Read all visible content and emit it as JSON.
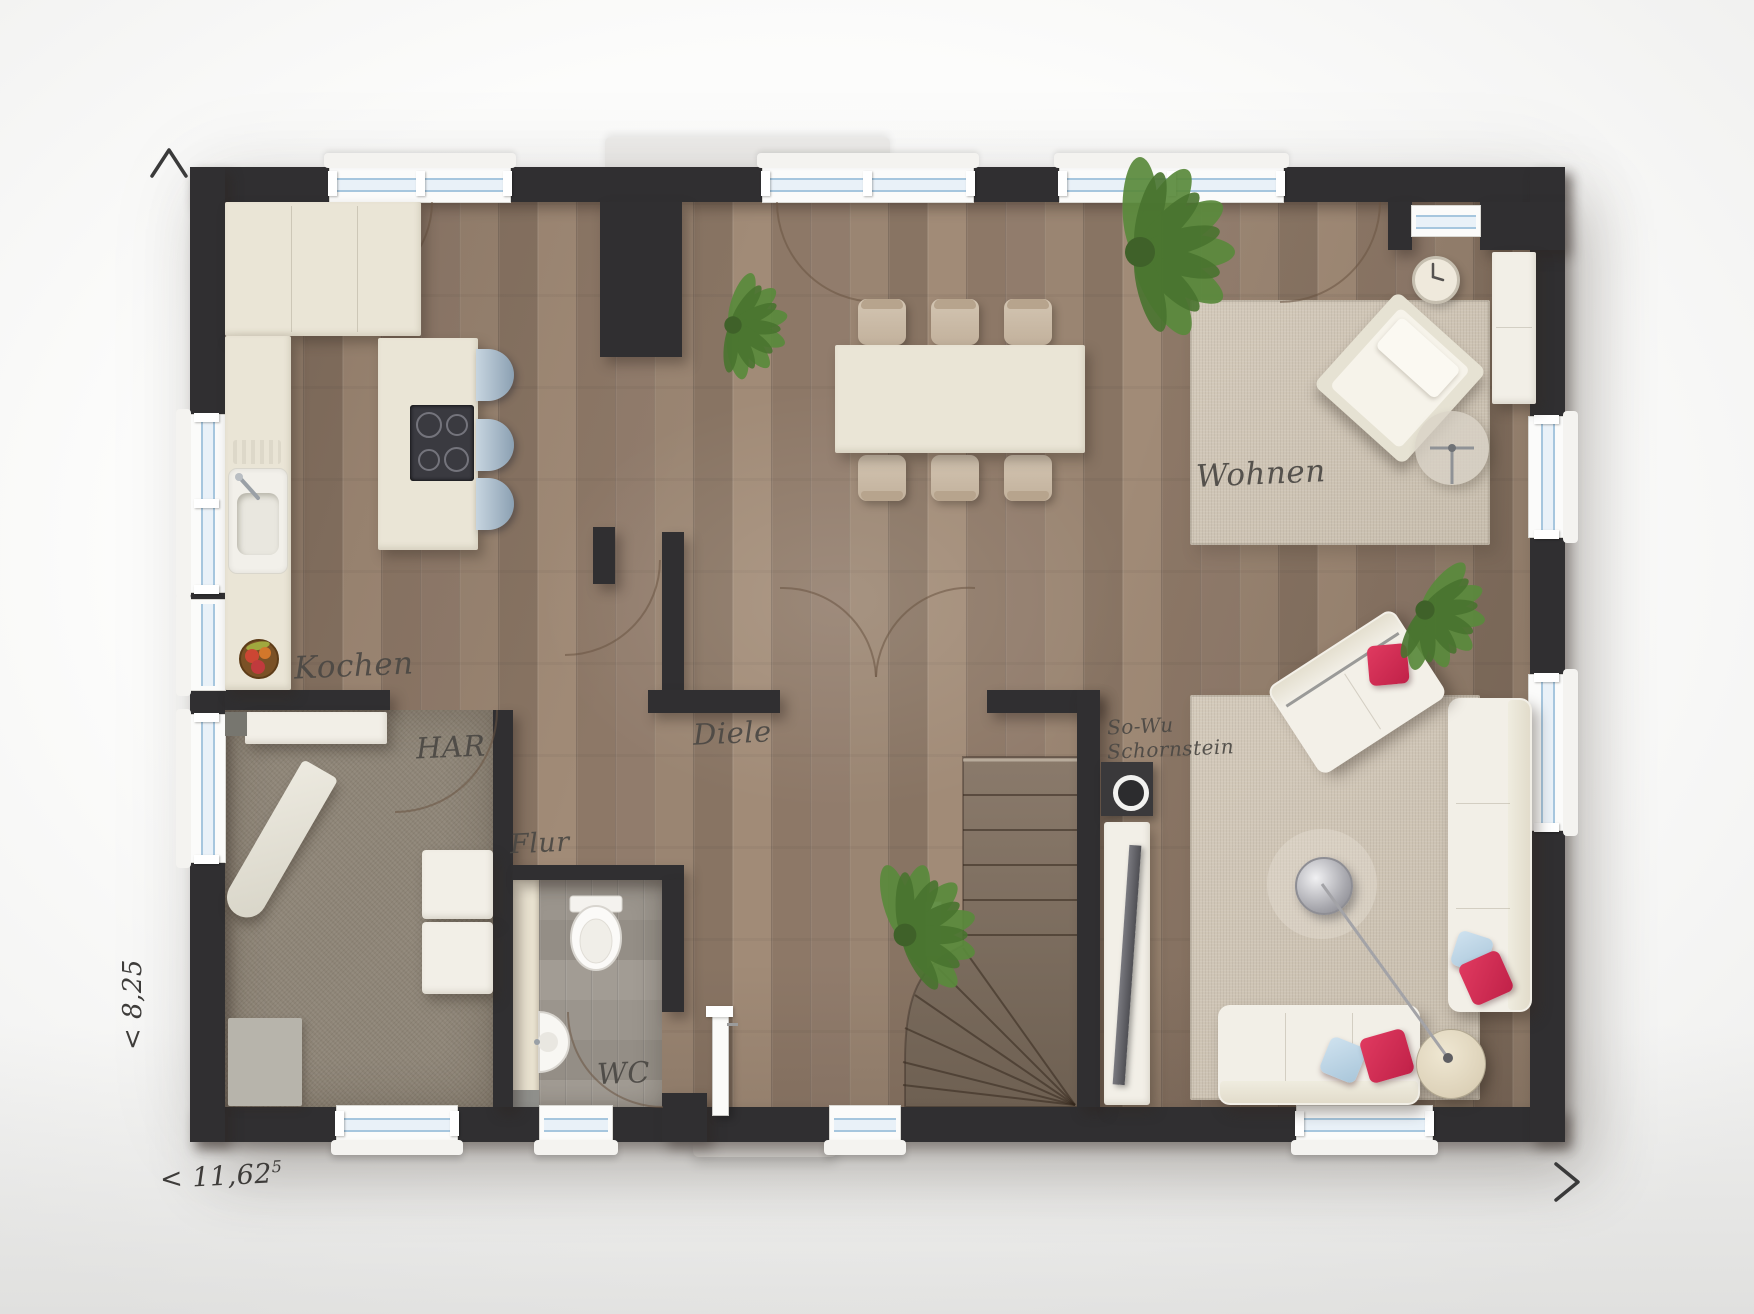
{
  "plan": {
    "title_hint": "ground floor plan rendering",
    "rooms": {
      "kochen": "Kochen",
      "har": "HAR",
      "flur": "Flur",
      "diele": "Diele",
      "wc": "WC",
      "wohnen": "Wohnen",
      "schornstein_line1": "So-Wu",
      "schornstein_line2": "Schornstein"
    },
    "dimensions": {
      "width": "< 11,62",
      "width_sup": "5",
      "depth": "< 8,25"
    },
    "markers": {
      "north": "^",
      "east": ">"
    },
    "colors": {
      "wall": "#302f31",
      "wood_floor": "#917c6c",
      "har_floor": "#8e8577",
      "wc_floor": "#98928a",
      "rug": "#cfc5b6",
      "cream_furniture": "#eae5d6",
      "accent_red": "#d22b52",
      "pillow_blue": "#b9d3e6",
      "glass": "#a6c6de",
      "stair_wood": "#7d6e60",
      "plant_green": "#5a8a3c",
      "label_text": "#4b4844"
    },
    "furniture_visible": [
      "kitchen-counter",
      "kitchen-island",
      "cooktop",
      "bar-stools",
      "kitchen-sink",
      "fruit-bowl",
      "dining-table",
      "dining-chairs",
      "terrace-door",
      "entrance-door",
      "staircase",
      "chimney",
      "tv-lowboard",
      "tv",
      "sofa-bottom",
      "sofa-right",
      "loveseat",
      "armchair",
      "coffee-table",
      "side-table",
      "floor-lamp",
      "wall-clock",
      "sideboard",
      "shelf",
      "ironing-board",
      "washer-dryer",
      "floor-mat",
      "toilet",
      "wash-basin",
      "plants",
      "rugs"
    ]
  }
}
